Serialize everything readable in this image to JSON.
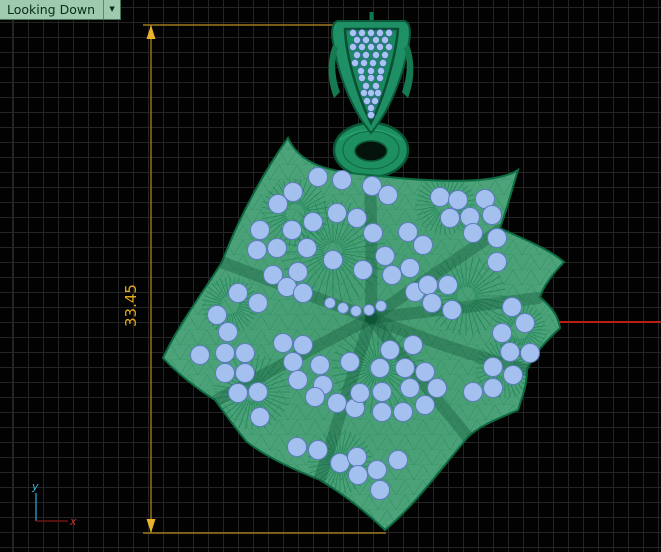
{
  "viewport": {
    "label": "Looking Down",
    "dropdown_icon": "▼"
  },
  "dimension": {
    "value": "33.45",
    "line_color": "#9c7a1e",
    "text_color": "#e3a81c"
  },
  "axis_icon": {
    "y_label": "y",
    "x_label": "x",
    "y_color": "#3bb6d9",
    "x_color": "#c0392b"
  },
  "colors": {
    "background": "#020202",
    "grid_minor": "#242424",
    "grid_major": "#787878",
    "world_x_axis": "#b51f15",
    "flower_fill": "#4da37a",
    "flower_wire": "#17784e",
    "bail_fill": "#1b9263",
    "gem_fill": "#a4c0ee",
    "tab_bg": "#9fcaae",
    "tab_text": "#0a2b1c"
  },
  "scene": {
    "flower_gems": [
      [
        318,
        177
      ],
      [
        342,
        180
      ],
      [
        293,
        192
      ],
      [
        278,
        204
      ],
      [
        337,
        213
      ],
      [
        313,
        222
      ],
      [
        357,
        218
      ],
      [
        260,
        230
      ],
      [
        292,
        230
      ],
      [
        257,
        250
      ],
      [
        277,
        248
      ],
      [
        307,
        248
      ],
      [
        333,
        260
      ],
      [
        273,
        275
      ],
      [
        298,
        272
      ],
      [
        363,
        270
      ],
      [
        287,
        287
      ],
      [
        238,
        293
      ],
      [
        258,
        303
      ],
      [
        303,
        293
      ],
      [
        217,
        315
      ],
      [
        228,
        332
      ],
      [
        372,
        186
      ],
      [
        388,
        195
      ],
      [
        440,
        197
      ],
      [
        458,
        200
      ],
      [
        485,
        199
      ],
      [
        450,
        218
      ],
      [
        470,
        217
      ],
      [
        492,
        215
      ],
      [
        408,
        232
      ],
      [
        373,
        233
      ],
      [
        423,
        245
      ],
      [
        385,
        256
      ],
      [
        410,
        268
      ],
      [
        473,
        233
      ],
      [
        497,
        238
      ],
      [
        392,
        275
      ],
      [
        497,
        262
      ],
      [
        415,
        292
      ],
      [
        428,
        285
      ],
      [
        448,
        285
      ],
      [
        432,
        303
      ],
      [
        452,
        310
      ],
      [
        512,
        307
      ],
      [
        525,
        323
      ],
      [
        502,
        333
      ],
      [
        200,
        355
      ],
      [
        225,
        353
      ],
      [
        245,
        353
      ],
      [
        283,
        343
      ],
      [
        303,
        345
      ],
      [
        293,
        362
      ],
      [
        320,
        365
      ],
      [
        350,
        362
      ],
      [
        225,
        373
      ],
      [
        245,
        373
      ],
      [
        238,
        393
      ],
      [
        258,
        392
      ],
      [
        298,
        380
      ],
      [
        323,
        385
      ],
      [
        315,
        397
      ],
      [
        337,
        403
      ],
      [
        260,
        417
      ],
      [
        355,
        408
      ],
      [
        360,
        393
      ],
      [
        297,
        447
      ],
      [
        318,
        450
      ],
      [
        340,
        463
      ],
      [
        357,
        457
      ],
      [
        358,
        475
      ],
      [
        380,
        368
      ],
      [
        390,
        350
      ],
      [
        413,
        345
      ],
      [
        405,
        368
      ],
      [
        425,
        372
      ],
      [
        382,
        392
      ],
      [
        410,
        388
      ],
      [
        437,
        388
      ],
      [
        382,
        412
      ],
      [
        403,
        412
      ],
      [
        425,
        405
      ],
      [
        473,
        392
      ],
      [
        493,
        388
      ],
      [
        493,
        367
      ],
      [
        510,
        352
      ],
      [
        530,
        353
      ],
      [
        513,
        375
      ],
      [
        398,
        460
      ],
      [
        377,
        470
      ],
      [
        380,
        490
      ]
    ],
    "arc_gems": [
      [
        330,
        303
      ],
      [
        343,
        308
      ],
      [
        356,
        311
      ],
      [
        369,
        310
      ],
      [
        381,
        306
      ]
    ],
    "bail_gems": [
      [
        353,
        33
      ],
      [
        362,
        33
      ],
      [
        371,
        33
      ],
      [
        380,
        33
      ],
      [
        389,
        33
      ],
      [
        357,
        40
      ],
      [
        366,
        40
      ],
      [
        376,
        40
      ],
      [
        385,
        40
      ],
      [
        353,
        47
      ],
      [
        362,
        47
      ],
      [
        371,
        47
      ],
      [
        380,
        47
      ],
      [
        389,
        47
      ],
      [
        357,
        55
      ],
      [
        366,
        55
      ],
      [
        376,
        55
      ],
      [
        385,
        55
      ],
      [
        355,
        63
      ],
      [
        364,
        63
      ],
      [
        373,
        63
      ],
      [
        383,
        63
      ],
      [
        361,
        71
      ],
      [
        371,
        71
      ],
      [
        381,
        71
      ],
      [
        362,
        78
      ],
      [
        371,
        78
      ],
      [
        380,
        78
      ],
      [
        366,
        86
      ],
      [
        376,
        86
      ],
      [
        364,
        93
      ],
      [
        371,
        93
      ],
      [
        378,
        93
      ],
      [
        367,
        101
      ],
      [
        375,
        101
      ],
      [
        371,
        108
      ],
      [
        371,
        115
      ]
    ],
    "fan_centers": [
      [
        333,
        252,
        52
      ],
      [
        466,
        296,
        40
      ],
      [
        378,
        368,
        46
      ],
      [
        295,
        213,
        34
      ],
      [
        252,
        392,
        38
      ],
      [
        340,
        462,
        32
      ],
      [
        505,
        368,
        30
      ],
      [
        445,
        205,
        30
      ],
      [
        230,
        305,
        28
      ],
      [
        520,
        330,
        26
      ]
    ]
  }
}
